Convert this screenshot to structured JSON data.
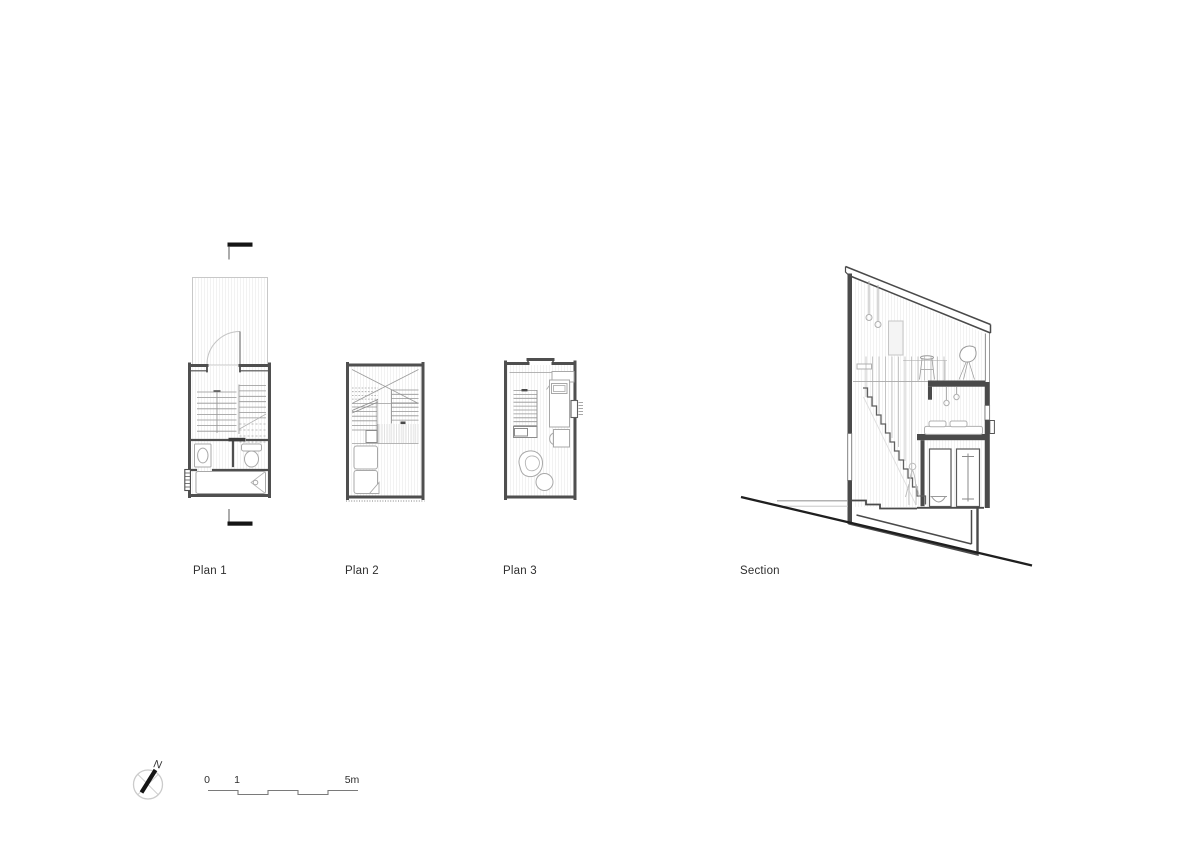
{
  "sheet": {
    "plans": [
      {
        "label": "Plan 1"
      },
      {
        "label": "Plan 2"
      },
      {
        "label": "Plan 3"
      }
    ],
    "section_label": "Section"
  },
  "compass": {
    "north_label": "N"
  },
  "scale_bar": {
    "ticks": [
      "0",
      "1",
      "5m"
    ]
  },
  "colors": {
    "wall_cut": "#4a4a4a",
    "furniture_line": "#a8a8a8",
    "light_line": "#c8c8c8",
    "ground_line": "#1f1f1f",
    "cut_marker": "#151515",
    "hatch": "#ededed",
    "text": "#2e2e2e",
    "background": "#ffffff"
  }
}
